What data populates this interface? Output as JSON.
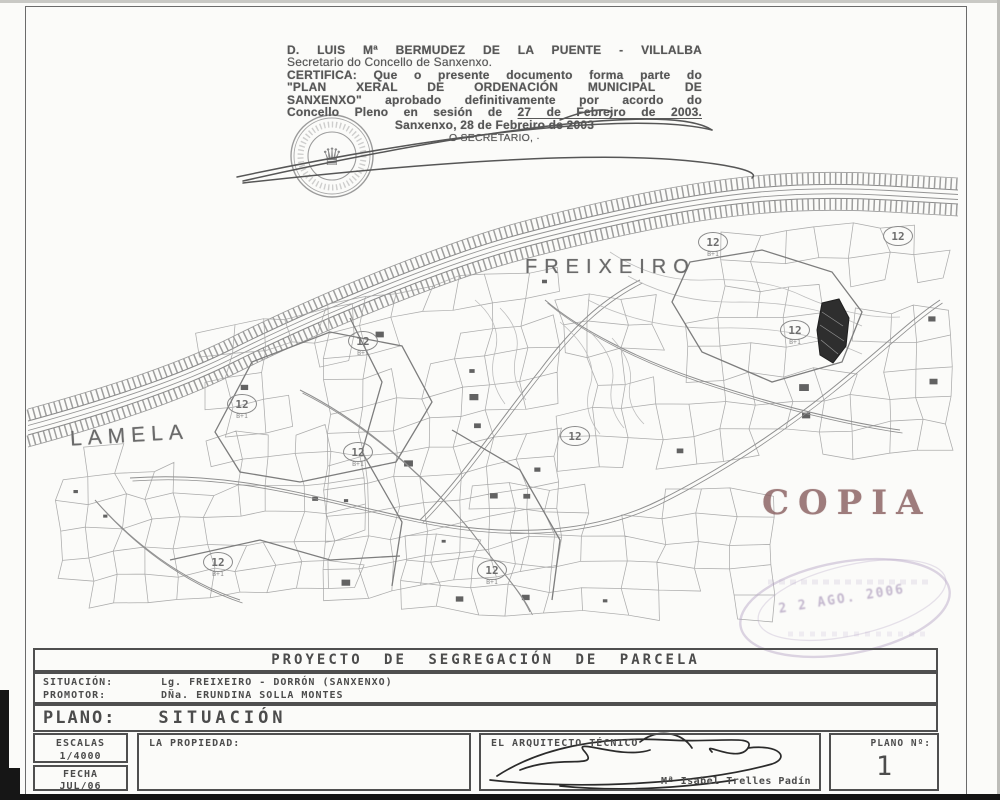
{
  "certification": {
    "line1": "D. LUIS Mª BERMUDEZ DE LA PUENTE - VILLALBA",
    "line2": "Secretario do Concello de Sanxenxo.",
    "line3": "CERTIFICA: Que o presente documento forma parte do",
    "line4": "\"PLAN XERAL DE ORDENACIÓN MUNICIPAL DE",
    "line5": "SANXENXO\" aprobado definitivamente por acordo do",
    "line6_prefix": "Concello Pleno en sesión de ",
    "line6_underlined": "27 de Febreiro de 2003.",
    "date_line": "Sanxenxo, 28 de Febreiro de 2003",
    "signer_line": "O SECRETARIO, ·"
  },
  "map": {
    "label_freixeiro": "FREIXEIRO",
    "label_lamela": "LAMELA",
    "copia_stamp": "COPIA",
    "date_stamp": "2 2 AGO. 2006",
    "zone_markers": [
      {
        "x": 242,
        "y": 404,
        "label": "12",
        "sub": "B+1",
        "circled": true
      },
      {
        "x": 363,
        "y": 341,
        "label": "12",
        "sub": "B+1",
        "circled": true
      },
      {
        "x": 358,
        "y": 452,
        "label": "12",
        "sub": "B+1",
        "circled": true
      },
      {
        "x": 575,
        "y": 436,
        "label": "12",
        "sub": "",
        "circled": true
      },
      {
        "x": 713,
        "y": 242,
        "label": "12",
        "sub": "B+1",
        "circled": true
      },
      {
        "x": 898,
        "y": 236,
        "label": "12",
        "sub": "",
        "circled": true
      },
      {
        "x": 795,
        "y": 330,
        "label": "12",
        "sub": "B+1",
        "circled": true
      },
      {
        "x": 218,
        "y": 562,
        "label": "12",
        "sub": "B+1",
        "circled": true
      },
      {
        "x": 492,
        "y": 570,
        "label": "12",
        "sub": "B+1",
        "circled": true
      }
    ]
  },
  "titleblock": {
    "project_title": "PROYECTO DE SEGREGACIÓN DE PARCELA",
    "situacion_label": "SITUACIÓN:",
    "situacion_value": "Lg. FREIXEIRO - DORRÓN (SANXENXO)",
    "promotor_label": "PROMOTOR:",
    "promotor_value": "DÑa. ERUNDINA SOLLA MONTES",
    "plano_label": "PLANO:",
    "plano_value": "SITUACIÓN",
    "escalas_label": "ESCALAS",
    "escalas_value": "1/4000",
    "fecha_label": "FECHA",
    "fecha_value": "JUL/06",
    "propiedad_label": "LA PROPIEDAD:",
    "arquitecto_label": "EL ARQUITECTO TÉCNICO",
    "arquitecto_name": "Mª Isabel Trelles Padín",
    "plano_num_label": "PLANO Nº:",
    "plano_num_value": "1"
  },
  "colors": {
    "copia": "#8a6161",
    "stamp_purple": "#a592b6",
    "ink": "#4c4c4c",
    "map_line": "#a3a3a3"
  }
}
